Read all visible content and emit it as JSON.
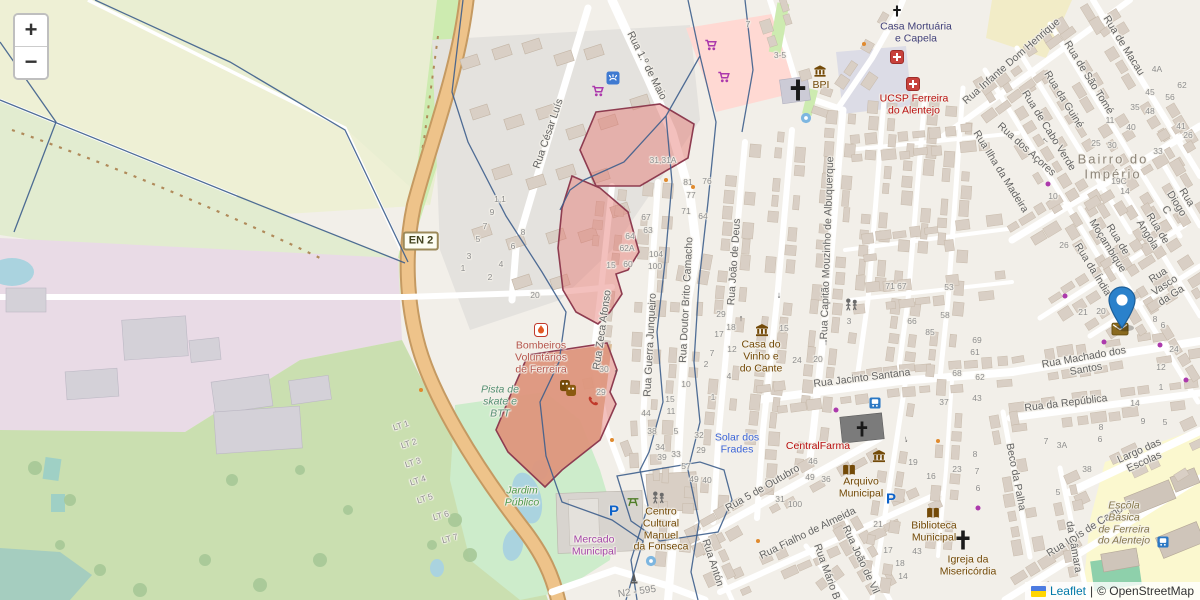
{
  "map": {
    "controls": {
      "zoom_in": "+",
      "zoom_out": "−"
    },
    "attribution": {
      "leaflet": "Leaflet",
      "separator": "|",
      "osm": "© OpenStreetMap"
    },
    "badges": [
      {
        "t": "EN 2",
        "x": 421,
        "y": 241,
        "style": "shield",
        "r": 0
      },
      {
        "t": "N2 - 595",
        "x": 637,
        "y": 592,
        "style": "plain",
        "r": -8
      }
    ],
    "street_labels": [
      {
        "t": "Rua César Luís",
        "x": 549,
        "y": 134,
        "r": -71
      },
      {
        "t": "Rua 1.º de Maio",
        "x": 646,
        "y": 66,
        "r": 63
      },
      {
        "t": "Rua Zeca Afonso",
        "x": 603,
        "y": 330,
        "r": -82
      },
      {
        "t": "Rua Guerra Junqueiro",
        "x": 651,
        "y": 345,
        "r": -87
      },
      {
        "t": "Rua Doutor Brito Camacho",
        "x": 687,
        "y": 300,
        "r": -87
      },
      {
        "t": "Rua João de Deus",
        "x": 735,
        "y": 262,
        "r": -86
      },
      {
        "t": "Rua Capitão Mouzinho de Albuquerque",
        "x": 828,
        "y": 248,
        "r": -88
      },
      {
        "t": "Rua Jacinto Santana",
        "x": 862,
        "y": 379,
        "r": -7
      },
      {
        "t": "Rua Machado dos Santos",
        "x": 1085,
        "y": 364,
        "r": -10
      },
      {
        "t": "Rua da República",
        "x": 1066,
        "y": 404,
        "r": -7
      },
      {
        "t": "Largo das Escolas",
        "x": 1142,
        "y": 457,
        "r": -24
      },
      {
        "t": "Rua Luís de Camões",
        "x": 1090,
        "y": 529,
        "r": -32
      },
      {
        "t": "Beco da Palha",
        "x": 1015,
        "y": 477,
        "r": 79
      },
      {
        "t": "Rua 5 de Outubro",
        "x": 763,
        "y": 489,
        "r": -30
      },
      {
        "t": "Rua Fialho de Almeida",
        "x": 808,
        "y": 534,
        "r": -26
      },
      {
        "t": "Rua Mário B",
        "x": 826,
        "y": 572,
        "r": 70
      },
      {
        "t": "Rua João de Vil",
        "x": 860,
        "y": 560,
        "r": 65
      },
      {
        "t": "Rua Antón",
        "x": 712,
        "y": 563,
        "r": 72
      },
      {
        "t": "da Câmara",
        "x": 1073,
        "y": 547,
        "r": 80
      },
      {
        "t": "Rua Infante Dom Henrique",
        "x": 1012,
        "y": 62,
        "r": -41
      },
      {
        "t": "Rua de Macau",
        "x": 1123,
        "y": 46,
        "r": 58
      },
      {
        "t": "Rua de São Tomé",
        "x": 1088,
        "y": 78,
        "r": 58
      },
      {
        "t": "Rua da Guiné",
        "x": 1063,
        "y": 100,
        "r": 58
      },
      {
        "t": "Rua de Cabo Verde",
        "x": 1048,
        "y": 131,
        "r": 58
      },
      {
        "t": "Rua dos Açores",
        "x": 1026,
        "y": 150,
        "r": 42
      },
      {
        "t": "Rua Ilha da Madeira",
        "x": 1000,
        "y": 172,
        "r": 58
      },
      {
        "t": "Rua de Moçambique",
        "x": 1112,
        "y": 243,
        "r": 58
      },
      {
        "t": "Rua de Angola",
        "x": 1152,
        "y": 232,
        "r": 58
      },
      {
        "t": "Rua Diogo C",
        "x": 1176,
        "y": 204,
        "r": 58
      },
      {
        "t": "Rua Vasco da Ga",
        "x": 1165,
        "y": 286,
        "r": -33
      },
      {
        "t": "Rua da Índia",
        "x": 1092,
        "y": 270,
        "r": 58
      }
    ],
    "poi_labels": [
      {
        "t": "Casa Mortuária\ne Capela",
        "x": 916,
        "y": 33,
        "cls": "worship"
      },
      {
        "t": "UCSP Ferreira\ndo Alentejo",
        "x": 914,
        "y": 105,
        "cls": "health"
      },
      {
        "t": "BPI",
        "x": 821,
        "y": 86,
        "cls": "amenity"
      },
      {
        "t": "Casa do\nVinho e\ndo Cante",
        "x": 761,
        "y": 357,
        "cls": "amenity"
      },
      {
        "t": "CentralFarma",
        "x": 818,
        "y": 447,
        "cls": "health"
      },
      {
        "t": "Solar dos\nFrades",
        "x": 737,
        "y": 444,
        "cls": "tourism"
      },
      {
        "t": "Arquivo\nMunicipal",
        "x": 861,
        "y": 488,
        "cls": "amenity"
      },
      {
        "t": "Biblioteca\nMunicipal",
        "x": 934,
        "y": 532,
        "cls": "amenity"
      },
      {
        "t": "Igreja da\nMisericórdia",
        "x": 968,
        "y": 566,
        "cls": "amenity"
      },
      {
        "t": "Bombeiros\nVoluntários\nde Ferreira",
        "x": 541,
        "y": 358,
        "cls": "fire"
      },
      {
        "t": "Pista de\nskate e\nBTT",
        "x": 500,
        "y": 402,
        "cls": "leisure"
      },
      {
        "t": "Jardim\nPúblico",
        "x": 522,
        "y": 497,
        "cls": "park"
      },
      {
        "t": "Mercado\nMunicipal",
        "x": 594,
        "y": 546,
        "cls": "shop"
      },
      {
        "t": "Centro\nCultural\nManuel\nda Fonseca",
        "x": 661,
        "y": 530,
        "cls": "amenity"
      },
      {
        "t": "Escola\nBásica\nde Ferreira\ndo Alentejo",
        "x": 1124,
        "y": 524,
        "cls": "school"
      },
      {
        "t": "Bairro do Império",
        "x": 1113,
        "y": 167,
        "cls": "place"
      }
    ],
    "lot_labels": [
      {
        "t": "LT 1",
        "x": 401,
        "y": 426,
        "r": -18
      },
      {
        "t": "LT 2",
        "x": 409,
        "y": 444,
        "r": -18
      },
      {
        "t": "LT 3",
        "x": 413,
        "y": 463,
        "r": -18
      },
      {
        "t": "LT 4",
        "x": 418,
        "y": 481,
        "r": -18
      },
      {
        "t": "LT 5",
        "x": 425,
        "y": 499,
        "r": -18
      },
      {
        "t": "LT 6",
        "x": 441,
        "y": 516,
        "r": -15
      },
      {
        "t": "LT 7",
        "x": 450,
        "y": 539,
        "r": -15
      }
    ],
    "house_numbers": [
      {
        "t": "31,31A",
        "x": 663,
        "y": 161
      },
      {
        "t": "81",
        "x": 688,
        "y": 183
      },
      {
        "t": "76",
        "x": 707,
        "y": 182
      },
      {
        "t": "77",
        "x": 691,
        "y": 196
      },
      {
        "t": "71",
        "x": 686,
        "y": 212
      },
      {
        "t": "64",
        "x": 703,
        "y": 217
      },
      {
        "t": "67",
        "x": 646,
        "y": 218
      },
      {
        "t": "63",
        "x": 648,
        "y": 231
      },
      {
        "t": "64",
        "x": 630,
        "y": 237
      },
      {
        "t": "62A",
        "x": 627,
        "y": 249
      },
      {
        "t": "15",
        "x": 611,
        "y": 266
      },
      {
        "t": "60",
        "x": 628,
        "y": 265
      },
      {
        "t": "104",
        "x": 656,
        "y": 255
      },
      {
        "t": "100",
        "x": 655,
        "y": 267
      },
      {
        "t": "30",
        "x": 604,
        "y": 370
      },
      {
        "t": "29",
        "x": 601,
        "y": 393
      },
      {
        "t": "10",
        "x": 686,
        "y": 385
      },
      {
        "t": "15",
        "x": 670,
        "y": 400
      },
      {
        "t": "11",
        "x": 671,
        "y": 412
      },
      {
        "t": "44",
        "x": 646,
        "y": 414
      },
      {
        "t": "38",
        "x": 652,
        "y": 432
      },
      {
        "t": "34",
        "x": 660,
        "y": 448
      },
      {
        "t": "5",
        "x": 676,
        "y": 432
      },
      {
        "t": "39",
        "x": 662,
        "y": 458
      },
      {
        "t": "33",
        "x": 676,
        "y": 455
      },
      {
        "t": "57",
        "x": 686,
        "y": 467
      },
      {
        "t": "49",
        "x": 694,
        "y": 480
      },
      {
        "t": "40",
        "x": 707,
        "y": 481
      },
      {
        "t": "32",
        "x": 699,
        "y": 436
      },
      {
        "t": "29",
        "x": 701,
        "y": 451
      },
      {
        "t": "29",
        "x": 721,
        "y": 315
      },
      {
        "t": "18",
        "x": 731,
        "y": 328
      },
      {
        "t": "17",
        "x": 719,
        "y": 335
      },
      {
        "t": "12",
        "x": 732,
        "y": 350
      },
      {
        "t": "24",
        "x": 797,
        "y": 361
      },
      {
        "t": "20",
        "x": 818,
        "y": 360
      },
      {
        "t": "15",
        "x": 784,
        "y": 329
      },
      {
        "t": "7",
        "x": 712,
        "y": 354
      },
      {
        "t": "4",
        "x": 729,
        "y": 377
      },
      {
        "t": "2",
        "x": 706,
        "y": 365
      },
      {
        "t": "1",
        "x": 713,
        "y": 398
      },
      {
        "t": "3",
        "x": 849,
        "y": 322
      },
      {
        "t": "71 67",
        "x": 896,
        "y": 287
      },
      {
        "t": "53",
        "x": 949,
        "y": 288
      },
      {
        "t": "58",
        "x": 945,
        "y": 316
      },
      {
        "t": "66",
        "x": 912,
        "y": 322
      },
      {
        "t": "85",
        "x": 930,
        "y": 333
      },
      {
        "t": "69",
        "x": 977,
        "y": 341
      },
      {
        "t": "61",
        "x": 975,
        "y": 353
      },
      {
        "t": "68",
        "x": 957,
        "y": 374
      },
      {
        "t": "62",
        "x": 980,
        "y": 378
      },
      {
        "t": "43",
        "x": 977,
        "y": 399
      },
      {
        "t": "37",
        "x": 944,
        "y": 403
      },
      {
        "t": "46",
        "x": 813,
        "y": 462
      },
      {
        "t": "49",
        "x": 810,
        "y": 478
      },
      {
        "t": "36",
        "x": 826,
        "y": 480
      },
      {
        "t": "31",
        "x": 780,
        "y": 500
      },
      {
        "t": "100",
        "x": 795,
        "y": 505
      },
      {
        "t": "21",
        "x": 878,
        "y": 525
      },
      {
        "t": "19",
        "x": 913,
        "y": 463
      },
      {
        "t": "23",
        "x": 957,
        "y": 470
      },
      {
        "t": "16",
        "x": 931,
        "y": 477
      },
      {
        "t": "8",
        "x": 975,
        "y": 455
      },
      {
        "t": "7",
        "x": 977,
        "y": 472
      },
      {
        "t": "6",
        "x": 978,
        "y": 489
      },
      {
        "t": "43",
        "x": 917,
        "y": 552
      },
      {
        "t": "17",
        "x": 888,
        "y": 551
      },
      {
        "t": "18",
        "x": 900,
        "y": 564
      },
      {
        "t": "14",
        "x": 903,
        "y": 577
      },
      {
        "t": "45",
        "x": 1150,
        "y": 93
      },
      {
        "t": "35",
        "x": 1135,
        "y": 108
      },
      {
        "t": "48",
        "x": 1150,
        "y": 112
      },
      {
        "t": "62",
        "x": 1182,
        "y": 86
      },
      {
        "t": "56",
        "x": 1170,
        "y": 98
      },
      {
        "t": "41",
        "x": 1181,
        "y": 127
      },
      {
        "t": "26",
        "x": 1188,
        "y": 136
      },
      {
        "t": "40",
        "x": 1131,
        "y": 128
      },
      {
        "t": "11",
        "x": 1110,
        "y": 121
      },
      {
        "t": "4A",
        "x": 1157,
        "y": 70
      },
      {
        "t": "25",
        "x": 1096,
        "y": 144
      },
      {
        "t": "30",
        "x": 1112,
        "y": 146
      },
      {
        "t": "33",
        "x": 1158,
        "y": 152
      },
      {
        "t": "19C",
        "x": 1119,
        "y": 182
      },
      {
        "t": "14",
        "x": 1125,
        "y": 192
      },
      {
        "t": "10",
        "x": 1053,
        "y": 197
      },
      {
        "t": "26",
        "x": 1064,
        "y": 246
      },
      {
        "t": "21",
        "x": 1083,
        "y": 313
      },
      {
        "t": "20",
        "x": 1101,
        "y": 312
      },
      {
        "t": "8",
        "x": 1155,
        "y": 320
      },
      {
        "t": "6",
        "x": 1163,
        "y": 326
      },
      {
        "t": "24",
        "x": 1174,
        "y": 350
      },
      {
        "t": "12",
        "x": 1161,
        "y": 368
      },
      {
        "t": "1",
        "x": 1161,
        "y": 388
      },
      {
        "t": "14",
        "x": 1135,
        "y": 404
      },
      {
        "t": "9",
        "x": 1143,
        "y": 422
      },
      {
        "t": "5",
        "x": 1165,
        "y": 423
      },
      {
        "t": "8",
        "x": 1101,
        "y": 428
      },
      {
        "t": "6",
        "x": 1100,
        "y": 440
      },
      {
        "t": "7",
        "x": 1046,
        "y": 442
      },
      {
        "t": "3A",
        "x": 1062,
        "y": 446
      },
      {
        "t": "38",
        "x": 1087,
        "y": 470
      },
      {
        "t": "5",
        "x": 1058,
        "y": 493
      },
      {
        "t": "1,1",
        "x": 500,
        "y": 200
      },
      {
        "t": "9",
        "x": 492,
        "y": 213
      },
      {
        "t": "7",
        "x": 485,
        "y": 227
      },
      {
        "t": "5",
        "x": 478,
        "y": 240
      },
      {
        "t": "3",
        "x": 469,
        "y": 257
      },
      {
        "t": "1",
        "x": 463,
        "y": 269
      },
      {
        "t": "8",
        "x": 523,
        "y": 233
      },
      {
        "t": "6",
        "x": 513,
        "y": 247
      },
      {
        "t": "4",
        "x": 501,
        "y": 265
      },
      {
        "t": "2",
        "x": 490,
        "y": 278
      },
      {
        "t": "20",
        "x": 535,
        "y": 296
      },
      {
        "t": "3-5",
        "x": 780,
        "y": 56
      },
      {
        "t": "7",
        "x": 748,
        "y": 25
      }
    ],
    "icons": [
      {
        "type": "hospital",
        "x": 897,
        "y": 57
      },
      {
        "type": "hospital",
        "x": 913,
        "y": 84
      },
      {
        "type": "cross",
        "x": 897,
        "y": 11,
        "s": 11
      },
      {
        "type": "cross",
        "x": 862,
        "y": 429,
        "s": 15
      },
      {
        "type": "cross",
        "x": 963,
        "y": 540,
        "s": 19
      },
      {
        "type": "cross",
        "x": 798,
        "y": 90,
        "s": 21
      },
      {
        "type": "bank",
        "x": 820,
        "y": 71
      },
      {
        "type": "museum",
        "x": 762,
        "y": 330
      },
      {
        "type": "townhall",
        "x": 879,
        "y": 456
      },
      {
        "type": "book",
        "x": 849,
        "y": 470
      },
      {
        "type": "book",
        "x": 933,
        "y": 513
      },
      {
        "type": "parking",
        "x": 614,
        "y": 511
      },
      {
        "type": "parking",
        "x": 891,
        "y": 499
      },
      {
        "type": "shopping-cart",
        "x": 598,
        "y": 91
      },
      {
        "type": "shopping-cart",
        "x": 711,
        "y": 45
      },
      {
        "type": "shopping-cart",
        "x": 724,
        "y": 77
      },
      {
        "type": "car-wash",
        "x": 613,
        "y": 78
      },
      {
        "type": "fire-station",
        "x": 541,
        "y": 330
      },
      {
        "type": "theatre-masks",
        "x": 568,
        "y": 388
      },
      {
        "type": "telephone",
        "x": 593,
        "y": 401
      },
      {
        "type": "picnic-table",
        "x": 633,
        "y": 501
      },
      {
        "type": "playground",
        "x": 658,
        "y": 498
      },
      {
        "type": "playground",
        "x": 851,
        "y": 305
      },
      {
        "type": "fountain",
        "x": 806,
        "y": 118
      },
      {
        "type": "fountain",
        "x": 651,
        "y": 561
      },
      {
        "type": "monument",
        "x": 634,
        "y": 578
      },
      {
        "type": "bus-stop",
        "x": 875,
        "y": 403
      },
      {
        "type": "bus-stop",
        "x": 1163,
        "y": 542
      },
      {
        "type": "post-box",
        "x": 1120,
        "y": 329
      }
    ],
    "shop_dots": [
      {
        "x": 1048,
        "y": 184
      },
      {
        "x": 1065,
        "y": 296
      },
      {
        "x": 1104,
        "y": 342
      },
      {
        "x": 1186,
        "y": 380
      },
      {
        "x": 978,
        "y": 508
      },
      {
        "x": 836,
        "y": 410
      },
      {
        "x": 1160,
        "y": 345
      }
    ],
    "poi_dots": [
      {
        "x": 666,
        "y": 180
      },
      {
        "x": 693,
        "y": 187
      },
      {
        "x": 612,
        "y": 440
      },
      {
        "x": 758,
        "y": 541
      },
      {
        "x": 938,
        "y": 441
      },
      {
        "x": 864,
        "y": 44
      },
      {
        "x": 421,
        "y": 390
      }
    ],
    "oneway_arrows": [
      {
        "x": 616,
        "y": 372,
        "r": 0
      },
      {
        "x": 655,
        "y": 305,
        "r": 180
      },
      {
        "x": 741,
        "y": 318,
        "r": 0
      },
      {
        "x": 779,
        "y": 296,
        "r": 180
      },
      {
        "x": 826,
        "y": 342,
        "r": 0
      },
      {
        "x": 906,
        "y": 440,
        "r": 170
      },
      {
        "x": 1045,
        "y": 140,
        "r": 310
      }
    ],
    "marker": {
      "x": 1122,
      "y": 329
    }
  }
}
